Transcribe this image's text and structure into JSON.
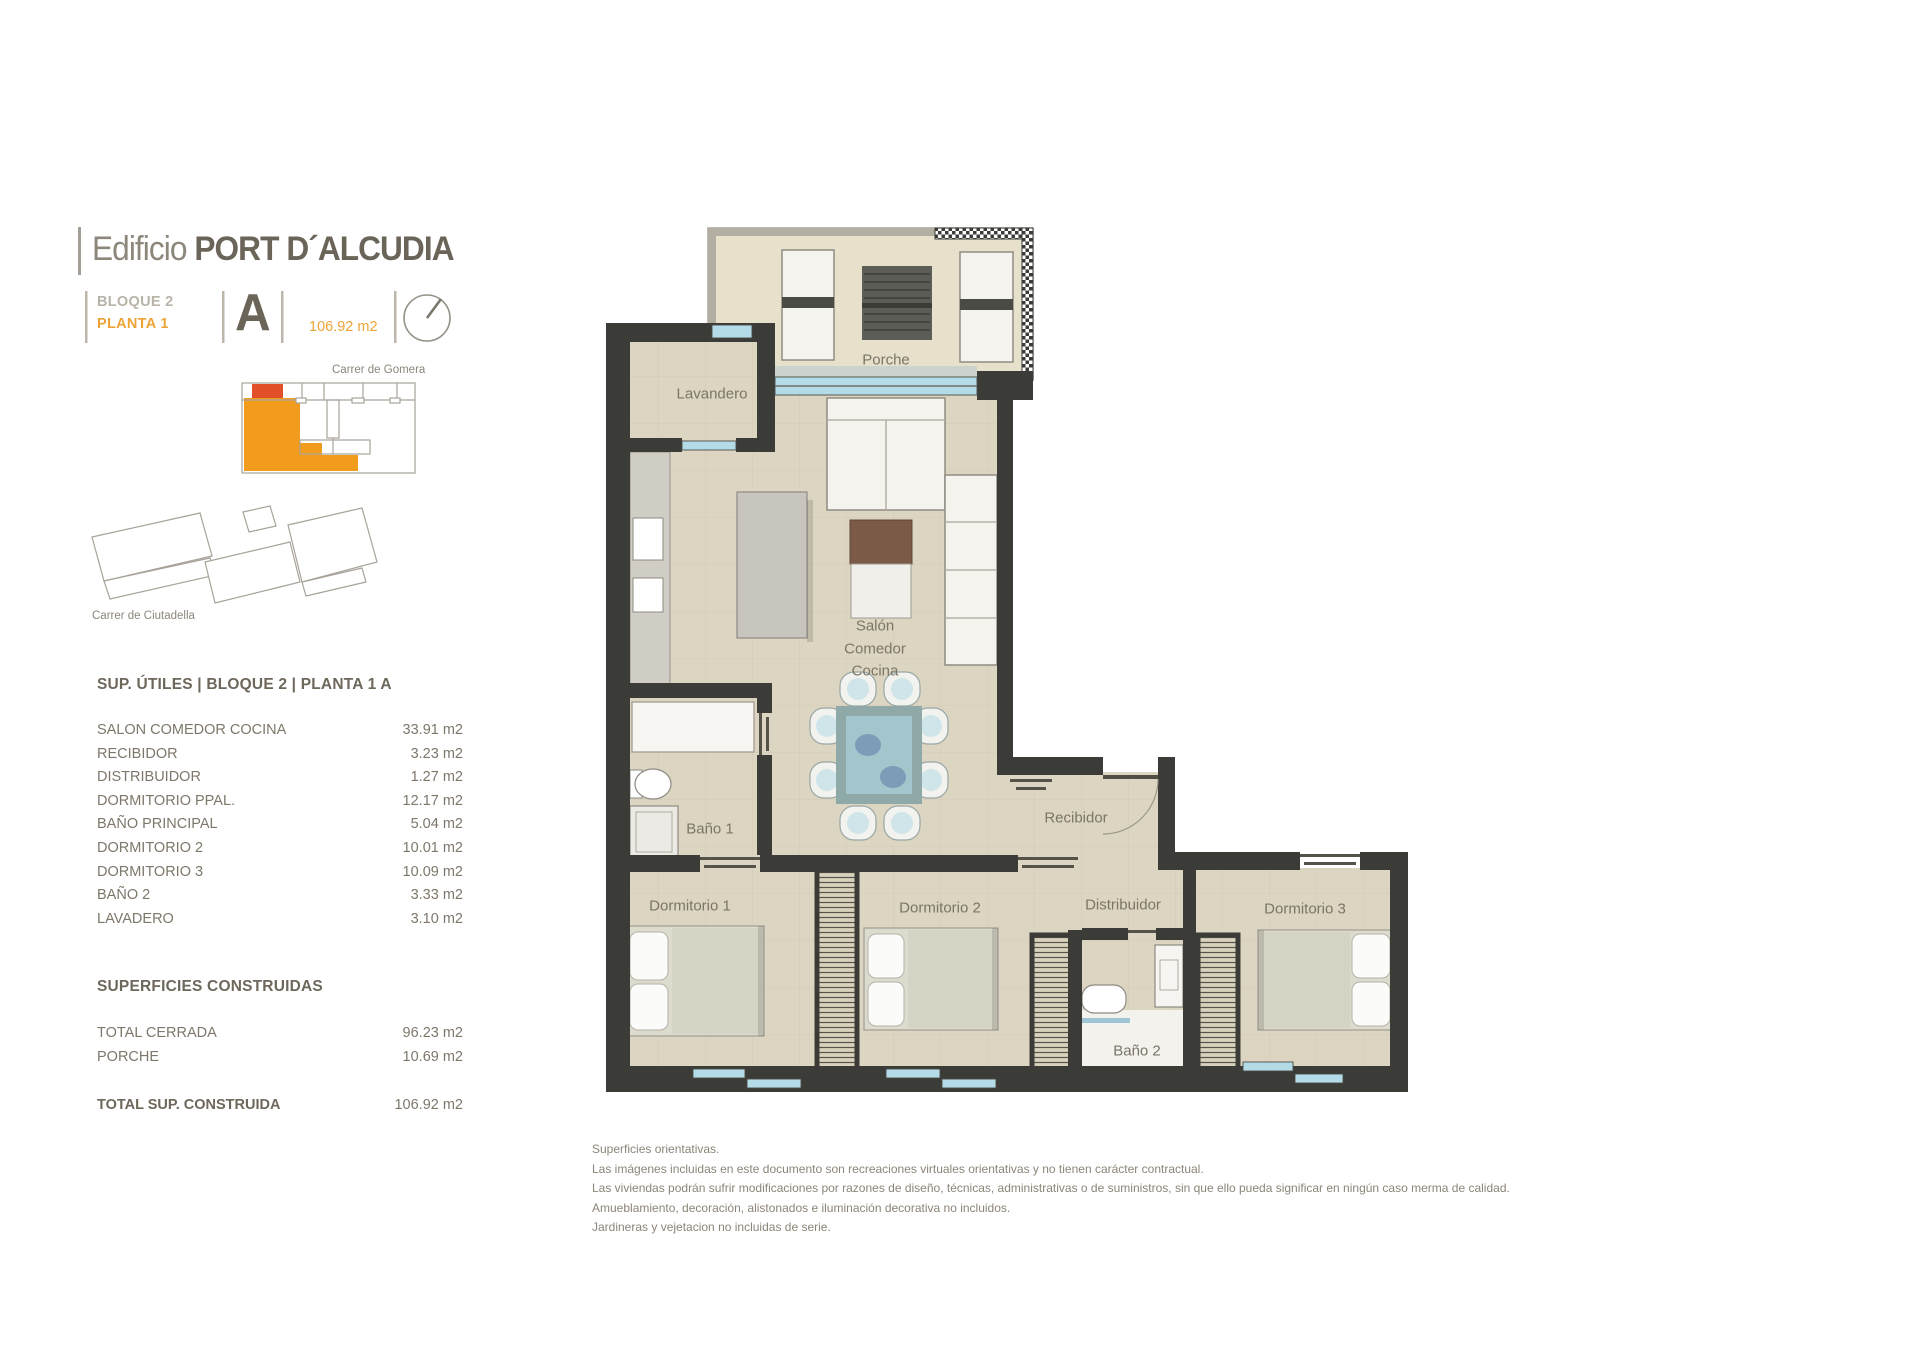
{
  "header": {
    "title_prefix": "Edificio",
    "title": "PORT D´ALCUDIA",
    "bloque": "BLOQUE 2",
    "planta": "PLANTA 1",
    "unit_letter": "A",
    "unit_area": "106.92 m2"
  },
  "site": {
    "street_top": "Carrer de Gomera",
    "street_bottom": "Carrer de Ciutadella"
  },
  "sup_utiles": {
    "heading": "SUP. ÚTILES | BLOQUE 2 | PLANTA 1 A",
    "rows": [
      {
        "name": "SALON COMEDOR COCINA",
        "value": "33.91 m2"
      },
      {
        "name": "RECIBIDOR",
        "value": "3.23 m2"
      },
      {
        "name": "DISTRIBUIDOR",
        "value": "1.27 m2"
      },
      {
        "name": "DORMITORIO PPAL.",
        "value": "12.17 m2"
      },
      {
        "name": "BAÑO PRINCIPAL",
        "value": "5.04 m2"
      },
      {
        "name": "DORMITORIO 2",
        "value": "10.01 m2"
      },
      {
        "name": "DORMITORIO 3",
        "value": "10.09 m2"
      },
      {
        "name": "BAÑO 2",
        "value": "3.33 m2"
      },
      {
        "name": "LAVADERO",
        "value": "3.10 m2"
      }
    ]
  },
  "sup_construidas": {
    "heading": "SUPERFICIES CONSTRUIDAS",
    "rows": [
      {
        "name": "TOTAL CERRADA",
        "value": "96.23 m2"
      },
      {
        "name": "PORCHE",
        "value": "10.69 m2"
      }
    ],
    "total_label": "TOTAL SUP. CONSTRUIDA",
    "total_value": "106.92 m2"
  },
  "plan": {
    "rooms": {
      "porche": "Porche",
      "lavandero": "Lavandero",
      "salon_line1": "Salón",
      "salon_line2": "Comedor",
      "salon_line3": "Cocina",
      "bano1": "Baño 1",
      "recibidor": "Recibidor",
      "dormitorio1": "Dormitorio 1",
      "dormitorio2": "Dormitorio 2",
      "distribuidor": "Distribuidor",
      "dormitorio3": "Dormitorio 3",
      "bano2": "Baño 2"
    }
  },
  "disclaimer": {
    "lines": [
      "Superficies orientativas.",
      "Las imágenes incluidas en este documento son recreaciones virtuales orientativas y no tienen carácter contractual.",
      "Las viviendas podrán sufrir modificaciones por razones de diseño, técnicas, administrativas o de suministros, sin que ello pueda significar en ningún caso merma de calidad.",
      "Amueblamiento, decoración, alistonados e iluminación decorativa no incluidos.",
      "Jardineras y vejetacion no incluidas de serie."
    ]
  },
  "colors": {
    "accent_orange": "#eca438",
    "highlight_orange": "#f29c1e",
    "highlight_red": "#e2502a",
    "wall_dark": "#3b3b38",
    "floor_beige": "#dcd5c1",
    "window_blue": "#b3dbe8",
    "text_brown": "#6e675b",
    "text_gray": "#8c8578"
  }
}
